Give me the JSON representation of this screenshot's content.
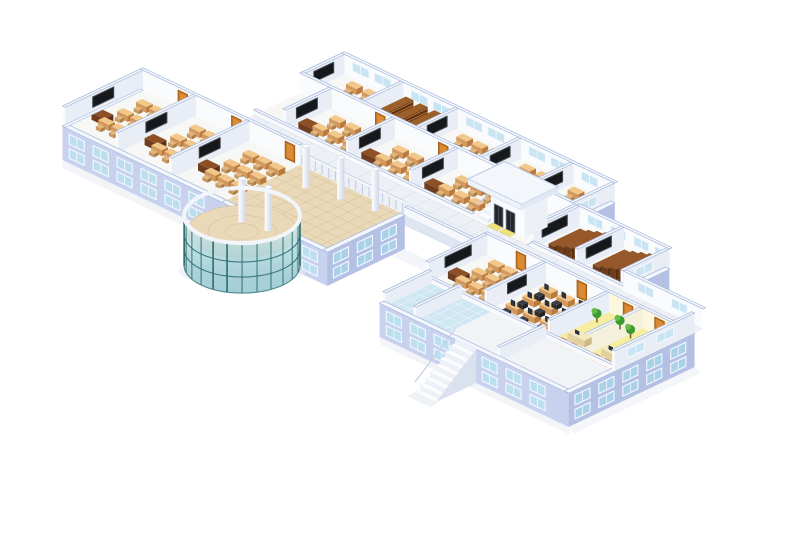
{
  "scene": {
    "type": "3d-isometric-building-cutaway",
    "background": "#ffffff"
  },
  "colors": {
    "background": "#ffffff",
    "shadow": "#e7ebf3",
    "floor": "#f7f7f5",
    "floorAlt": "#f2f3f6",
    "corridorFloor": "#edf0f5",
    "corridorLine": "#dadfe7",
    "hallFloor": "#ead9b9",
    "hallLine": "#d6c29a",
    "innerWallSW": "#fafbfd",
    "innerWallSE": "#e9edf5",
    "wallTop": "#f3f6fb",
    "wallEdge": "#a8b9dc",
    "cornice": "#f3f6fc",
    "facadeSW": "#c8d2ee",
    "facadeSE": "#b4c1e5",
    "windowPane": "#bcdff0",
    "windowPaneDark": "#a9d2e8",
    "windowPaneInner": "#c9e5f3",
    "windowFrame": "#f4f8fd",
    "door": "#c3701f",
    "doorDark": "#9a5515",
    "doorPanel": "#d98c34",
    "screen": "#16181c",
    "screenFrame": "#464a51",
    "deskTop": "#f2c78a",
    "deskFront": "#d3985c",
    "deskSide": "#b87a3e",
    "seatTop": "#e2b57e",
    "seatFront": "#c89a60",
    "seatSide": "#aa7d47",
    "teacherTop": "#8d4f26",
    "teacherFront": "#6f3d1d",
    "teacherSide": "#5d3115",
    "shelf": "#7c431d",
    "shelfTop": "#9c5f2a",
    "shelfSide": "#5f3012",
    "shelfLine": "#c07c3a",
    "seatRow": "#6e3c1c",
    "seatRowTop": "#96582a",
    "seatRowSide": "#54300f",
    "seatSlat": "#b5794a",
    "labChair": "#2c2e33",
    "labChairDark": "#1e2023",
    "monitor": "#1d2530",
    "monitorFace": "#2a3442",
    "yellowFloor": "#f5eda0",
    "yellowGlow": "#fff3bf",
    "redChair": "#d23a28",
    "redChairDark": "#a82417",
    "counterTop": "#f5e9c2",
    "counterFront": "#e3d0a0",
    "counterSide": "#cdb982",
    "plant": "#3c9a33",
    "plantLight": "#66bb4a",
    "plantStem": "#7a5a30",
    "tileBlue": "#cfe7f2",
    "tileLine": "#eef7fb",
    "mullion": "#2e6f6e",
    "glassA": "#d9eef2",
    "glassB": "#a7d2da",
    "glassC": "#8fc3cf",
    "columnA": "#ffffff",
    "columnB": "#cfd7e8",
    "railing": "#c2cde6",
    "railTop": "#f2f5fa",
    "stairTread": "#fbfcfe",
    "stairRiser": "#eef1f8",
    "stairSide": "#dbe2ef",
    "roof": "#f3f6fb",
    "roofEdge": "#bcc9e6",
    "fascia": "#dfe6f2",
    "matYellow": "#efe27c",
    "matEdge": "#d9ca67",
    "elevatorDoor": "#24262c",
    "elevatorFrame": "#9aa0ac"
  },
  "building": {
    "top_wing": {
      "back_rooms": [
        "classroom",
        "library-stacks",
        "classroom",
        "classroom",
        "classroom"
      ],
      "front_rooms": [
        "classroom",
        "classroom",
        "classroom"
      ],
      "library_shelf_rows": 3,
      "clerestory_windows": true,
      "east_facade_window_rows": 2
    },
    "left_wing": {
      "rooms": [
        "classroom",
        "classroom",
        "classroom"
      ],
      "desks_per_classroom": 9,
      "wall_screen_per_room": 1,
      "teacher_desk_per_room": 1,
      "facade_window_rows": 2
    },
    "entrance": {
      "lobby": "tiled-hall",
      "columns": 3,
      "balcony_railing": true,
      "rotunda": "glass-cylinder-curtain-wall"
    },
    "bridge": {
      "elevated_corridor": true,
      "elevators": 2,
      "yellow_mats": 2,
      "staircase": true,
      "roof_canopy": true
    },
    "right_wing": {
      "lecture_halls": 2,
      "tier_rows_per_hall": 4,
      "rooms": [
        "classroom",
        "computer-lab",
        "staff-room-a",
        "staff-room-b",
        "washroom",
        "washroom"
      ],
      "computer_workstations": 9,
      "external_staircase": true,
      "facade_window_rows": 2
    }
  }
}
